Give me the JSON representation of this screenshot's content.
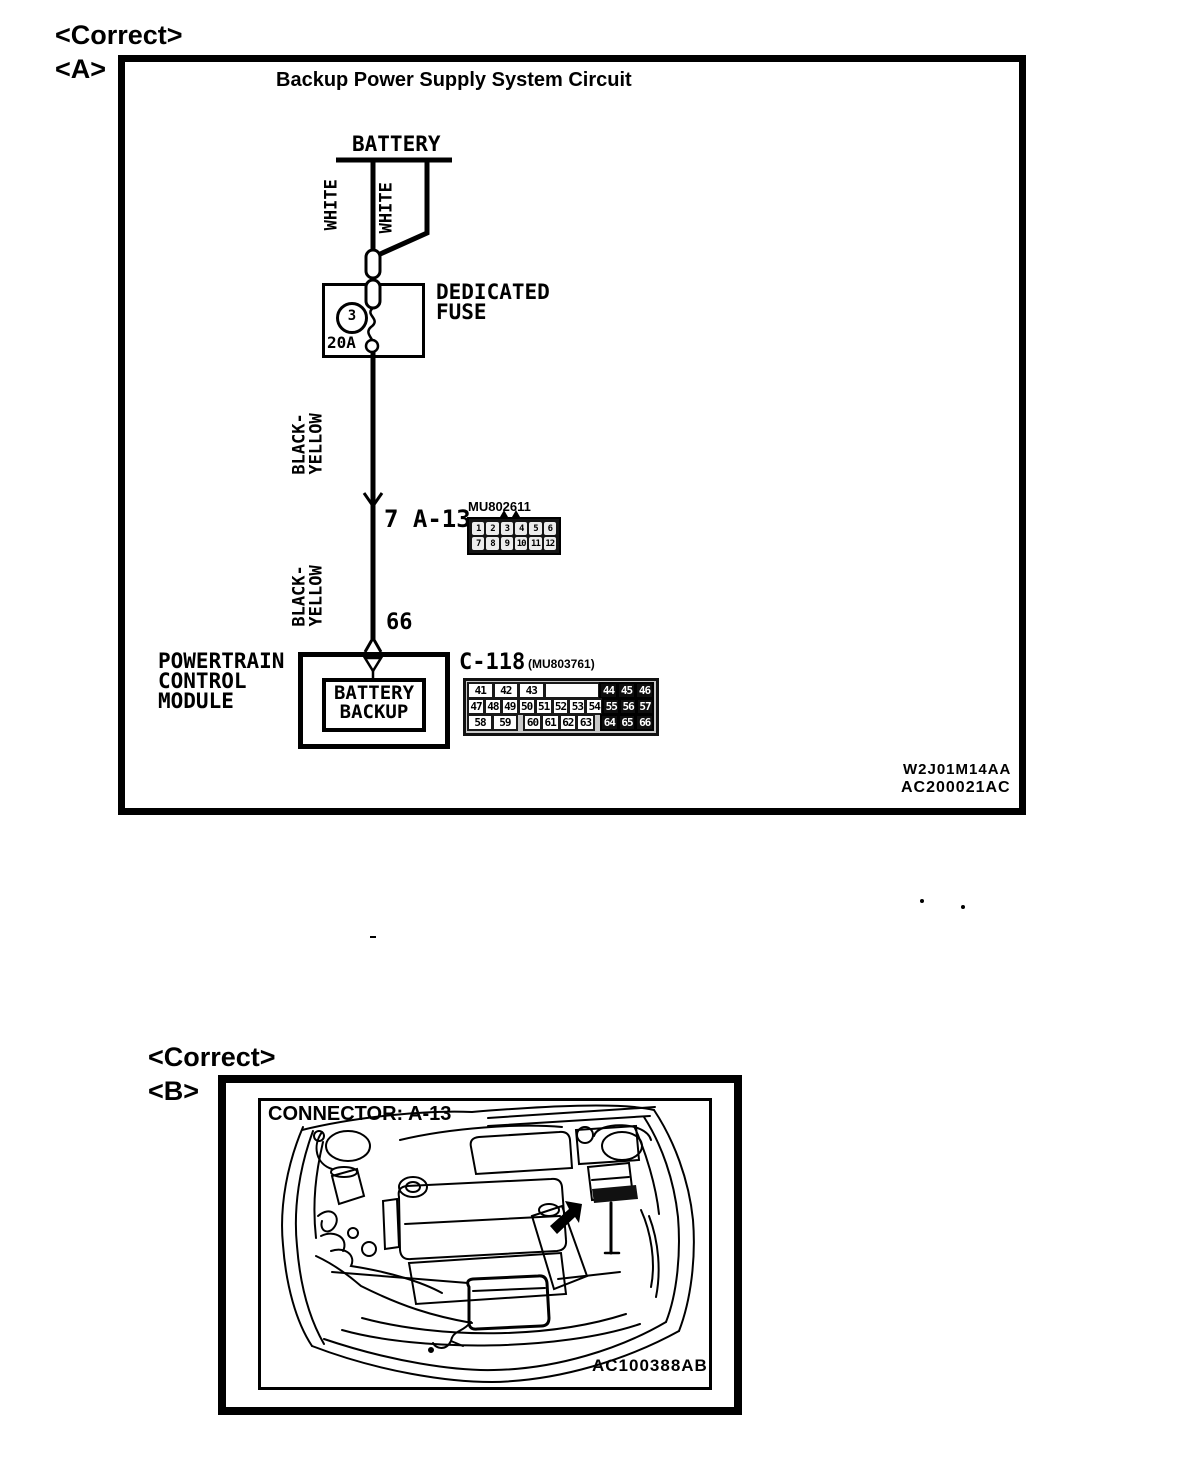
{
  "colors": {
    "ink": "#000000",
    "paper": "#ffffff",
    "connector_dark": "#101010",
    "connector_body_gray": "#c9c9c9"
  },
  "a": {
    "correct": "<Correct>",
    "tag": "<A>",
    "title": "Backup Power Supply System Circuit",
    "battery": "BATTERY",
    "white1": "WHITE",
    "white2": "WHITE",
    "fuse_number": "3",
    "fuse_rating": "20A",
    "fuse_name": "DEDICATED\nFUSE",
    "by1": "BLACK-\nYELLOW",
    "by2": "BLACK-\nYELLOW",
    "junction": "7 A-13",
    "a13_code": "MU802611",
    "a13_rows": [
      [
        "1",
        "2",
        "3",
        "4",
        "5",
        "6"
      ],
      [
        "7",
        "8",
        "9",
        "10",
        "11",
        "12"
      ]
    ],
    "pin66": "66",
    "pcm": "POWERTRAIN\nCONTROL\nMODULE",
    "pcm_inner": "BATTERY\nBACKUP",
    "c118": "C-118",
    "c118_code": "(MU803761)",
    "c118_rows": [
      [
        {
          "t": "41",
          "w": 1.5
        },
        {
          "t": "42",
          "w": 1.5
        },
        {
          "t": "43",
          "w": 1.5
        },
        {
          "t": "",
          "w": 3.5,
          "blank": true,
          "boxed": true
        },
        {
          "t": "44",
          "w": 1,
          "dark": true
        },
        {
          "t": "45",
          "w": 1,
          "dark": true
        },
        {
          "t": "46",
          "w": 1,
          "dark": true
        }
      ],
      [
        {
          "t": "47",
          "w": 1
        },
        {
          "t": "48",
          "w": 1
        },
        {
          "t": "49",
          "w": 1
        },
        {
          "t": "50",
          "w": 1
        },
        {
          "t": "51",
          "w": 1
        },
        {
          "t": "52",
          "w": 1
        },
        {
          "t": "53",
          "w": 1
        },
        {
          "t": "54",
          "w": 1
        },
        {
          "t": "55",
          "w": 1,
          "dark": true
        },
        {
          "t": "56",
          "w": 1,
          "dark": true
        },
        {
          "t": "57",
          "w": 1,
          "dark": true
        }
      ],
      [
        {
          "t": "58",
          "w": 1.5
        },
        {
          "t": "59",
          "w": 1.5
        },
        {
          "t": "",
          "w": 0.5,
          "blank": true
        },
        {
          "t": "60",
          "w": 1
        },
        {
          "t": "61",
          "w": 1
        },
        {
          "t": "62",
          "w": 1
        },
        {
          "t": "63",
          "w": 1
        },
        {
          "t": "",
          "w": 0.5,
          "blank": true
        },
        {
          "t": "64",
          "w": 1,
          "dark": true
        },
        {
          "t": "65",
          "w": 1,
          "dark": true
        },
        {
          "t": "66",
          "w": 1,
          "dark": true
        }
      ]
    ],
    "code1": "W2J01M14AA",
    "code2": "AC200021AC"
  },
  "b": {
    "correct": "<Correct>",
    "tag": "<B>",
    "title": "CONNECTOR: A-13",
    "code": "AC100388AB"
  }
}
